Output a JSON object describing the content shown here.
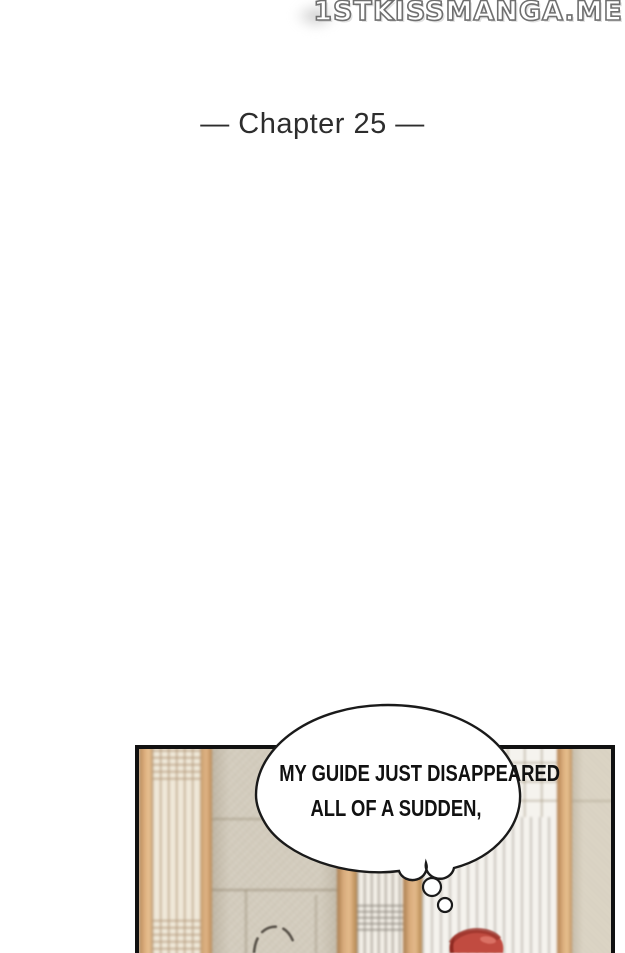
{
  "watermark": {
    "text": "1STKISSMANGA.ME",
    "fill_color": "#ffffff",
    "outline_color": "#6f6f6f"
  },
  "chapter": {
    "title": "— Chapter 25 —",
    "text_color": "#2d2d2d"
  },
  "panel": {
    "border_color": "#111111",
    "bubble": {
      "line1": "MY GUIDE JUST DISAPPEARED",
      "line2": "ALL OF A SUDDEN,",
      "fill_color": "#ffffff",
      "outline_color": "#1a1a1a",
      "text_color": "#111111"
    },
    "art_colors": {
      "wall_beige": "#d5cebf",
      "wood_post": "#dcae7c",
      "shoji_door_paper": "#f2eee6",
      "lattice_line": "#b09476",
      "character_hair_red": "#c14b40",
      "head_sketch_line": "#4a443c"
    }
  }
}
